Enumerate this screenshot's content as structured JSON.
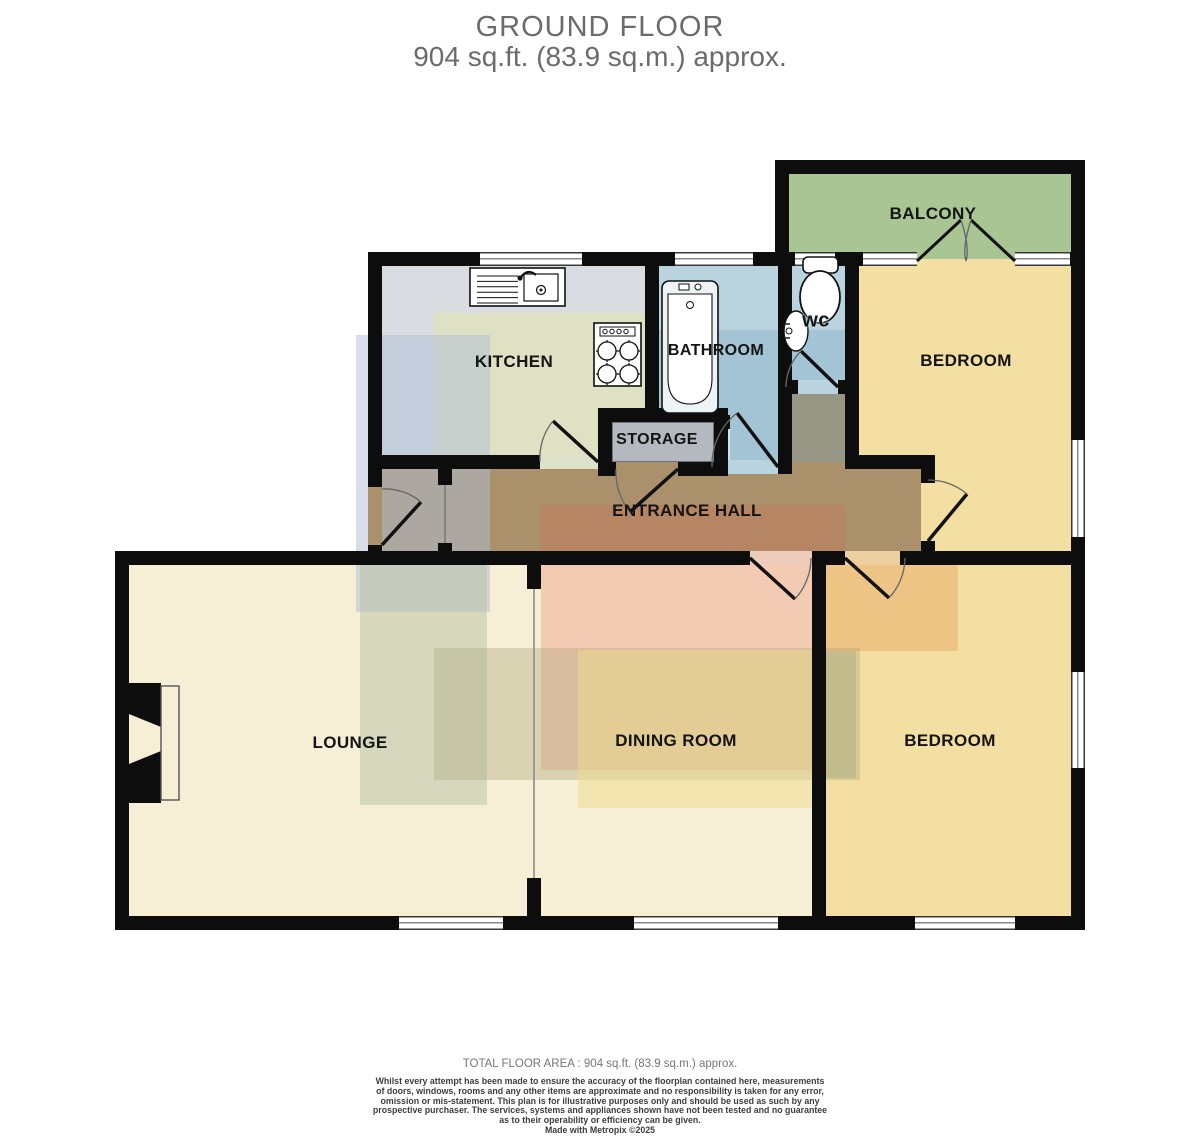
{
  "title": {
    "line1": "GROUND FLOOR",
    "line2": "904 sq.ft. (83.9 sq.m.) approx."
  },
  "rooms": {
    "balcony": {
      "label": "BALCONY",
      "color": "#a8c593"
    },
    "kitchen": {
      "label": "KITCHEN",
      "color": "#d9dce0"
    },
    "bathroom": {
      "label": "BATHROOM",
      "color": "#b9d4de"
    },
    "wc": {
      "label": "wc",
      "color": "#b9d4de"
    },
    "bedroom_top": {
      "label": "BEDROOM",
      "color": "#f3dfa2"
    },
    "storage": {
      "label": "STORAGE",
      "color": "#b4b9c0"
    },
    "entrance_hall": {
      "label": "ENTRANCE HALL",
      "color": "#aa916c"
    },
    "lounge": {
      "label": "LOUNGE",
      "color": "#f6efd5"
    },
    "dining_room": {
      "label": "DINING ROOM",
      "color": "#f6efd5"
    },
    "bedroom_bottom": {
      "label": "BEDROOM",
      "color": "#f3dfa2"
    }
  },
  "fixtures": [
    "kitchen-sink",
    "hob",
    "bathtub",
    "toilet",
    "wash-basin",
    "fireplace"
  ],
  "colors": {
    "wall": "#0d0d0d",
    "title_text": "#6b6b6b",
    "label_text": "#141414",
    "dining_tint": "#f1ac96",
    "hall_tint": "#c67a5c",
    "overlay_blue": "#b6c3d8",
    "overlay_green": "#bac5aa"
  },
  "footer": {
    "total": "TOTAL FLOOR AREA : 904 sq.ft. (83.9 sq.m.) approx.",
    "disclaimer_lines": [
      "Whilst every attempt has been made to ensure the accuracy of the floorplan contained here, measurements",
      "of doors, windows, rooms and any other items are approximate and no responsibility is taken for any error,",
      "omission or mis-statement. This plan is for illustrative purposes only and should be used as such by any",
      "prospective purchaser. The services, systems and appliances shown have not been tested and no guarantee",
      "as to their operability or efficiency can be given."
    ],
    "credit": "Made with Metropix ©2025"
  }
}
